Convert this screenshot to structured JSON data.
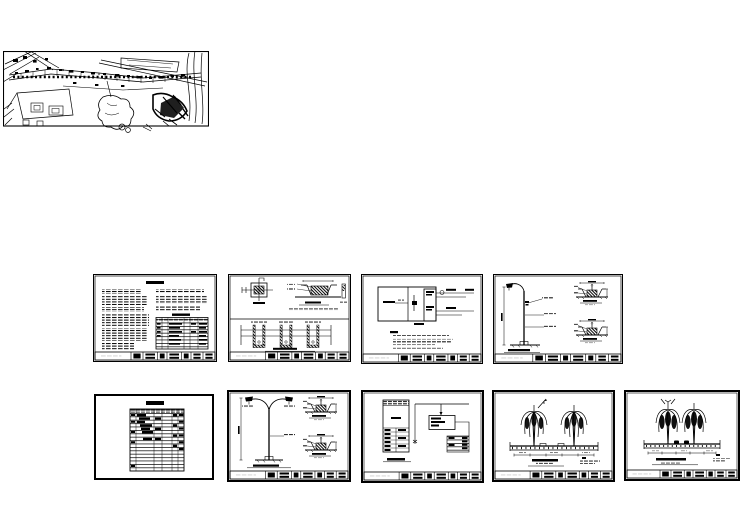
{
  "canvas": {
    "width": 749,
    "height": 530,
    "background": "#ffffff",
    "ink": "#000000"
  },
  "plan": {
    "kind": "street-lighting-site-plan",
    "description": "Dense black line-work site plan of a road corridor with lighting layout"
  },
  "sheets": [
    {
      "id": "m1",
      "row": "middle",
      "kind": "design-notes-sheet-with-material-table",
      "has_title_block": true
    },
    {
      "id": "m2",
      "row": "middle",
      "kind": "pole-foundation-plan-section-and-cable-trench-details-sheet",
      "has_title_block": true
    },
    {
      "id": "m3",
      "row": "middle",
      "kind": "power-distribution-system-schematic-sheet-with-notes",
      "has_title_block": true
    },
    {
      "id": "m4",
      "row": "middle",
      "kind": "single-arm-street-lamp-elevation-and-foundation-details-sheet",
      "has_title_block": true
    },
    {
      "id": "b1",
      "row": "bottom",
      "kind": "equipment-schedule-table-sheet",
      "has_title_block": false
    },
    {
      "id": "b2",
      "row": "bottom",
      "kind": "double-arm-street-lamp-elevation-and-foundation-details-sheet",
      "has_title_block": true
    },
    {
      "id": "b3",
      "row": "bottom",
      "kind": "distribution-box-wiring-system-diagram-sheet",
      "has_title_block": true
    },
    {
      "id": "b4",
      "row": "bottom",
      "kind": "road-cross-section-with-landscape-tree-lamps-sheet-wide",
      "has_title_block": true
    },
    {
      "id": "b5",
      "row": "bottom",
      "kind": "road-cross-section-with-landscape-tree-lamps-sheet-narrow",
      "has_title_block": true
    }
  ],
  "note": "All sheet text is below legibility at capture resolution; text is represented as redaction marks"
}
